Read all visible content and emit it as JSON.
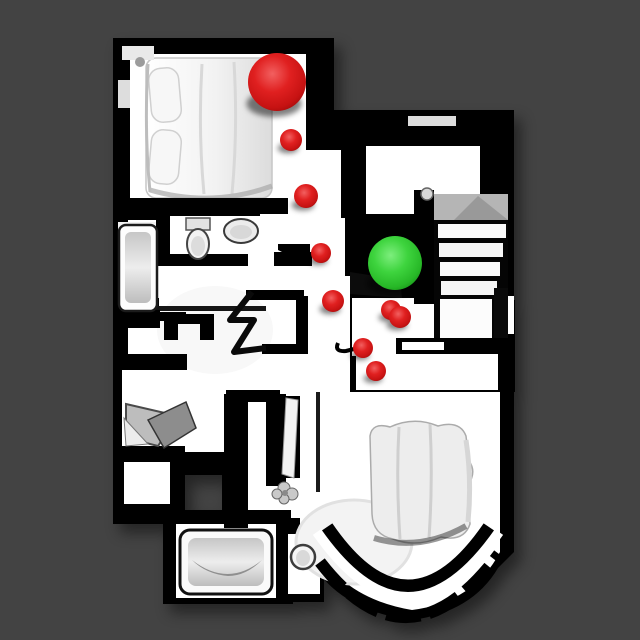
{
  "scene": {
    "view_label": "top-down-house-scan",
    "background_color": "#434343",
    "floor_color": "#ffffff",
    "wall_color": "#000000",
    "furniture_color": "#ececec",
    "stair_landing_color": "#b5b5b5"
  },
  "markers": {
    "start": {
      "shape": "sphere",
      "color": "#d21616",
      "x": 277,
      "y": 82,
      "r": 29
    },
    "goal": {
      "shape": "sphere",
      "color": "#2fc32f",
      "x": 395,
      "y": 263,
      "r": 27
    },
    "waypoint_color": "#d21616",
    "waypoints": [
      {
        "x": 291,
        "y": 140,
        "r": 11
      },
      {
        "x": 306,
        "y": 196,
        "r": 12
      },
      {
        "x": 321,
        "y": 253,
        "r": 10
      },
      {
        "x": 333,
        "y": 301,
        "r": 11
      },
      {
        "x": 391,
        "y": 310,
        "r": 10
      },
      {
        "x": 400,
        "y": 317,
        "r": 11
      },
      {
        "x": 363,
        "y": 348,
        "r": 10
      },
      {
        "x": 376,
        "y": 371,
        "r": 10
      }
    ],
    "red_gradient": [
      "#f26060",
      "#e02020",
      "#c61212",
      "#8e0707"
    ],
    "green_gradient": [
      "#7dee7d",
      "#3ed43e",
      "#27b827",
      "#128312"
    ]
  }
}
